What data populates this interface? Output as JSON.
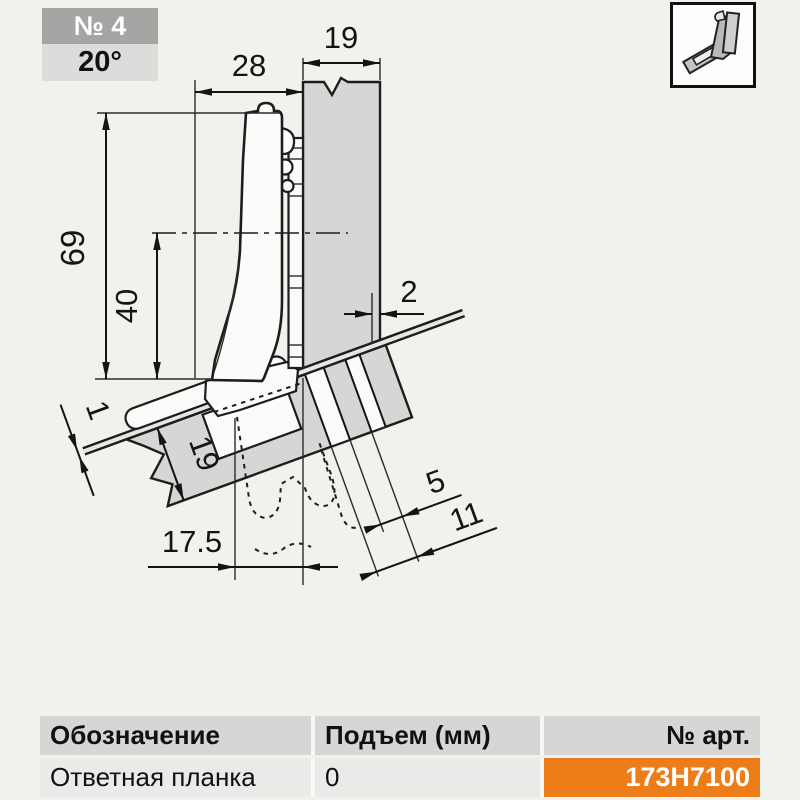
{
  "badge": {
    "number": "№ 4",
    "angle": "20°"
  },
  "thumbnail": {
    "icon": "hinge-side-view-icon"
  },
  "diagram": {
    "dimensions": {
      "side_panel_thickness": "19",
      "arm_depth": "28",
      "overall_height": "69",
      "center_height": "40",
      "back_offset": "2",
      "reveal": "1",
      "door_thickness": "19",
      "hole_offset_small": "5",
      "hole_offset_large": "11",
      "cup_distance": "17.5"
    }
  },
  "table": {
    "headers": [
      "Обозначение",
      "Подъем (мм)",
      "№ арт."
    ],
    "row": {
      "designation": "Ответная планка",
      "lift": "0",
      "art_no": "173H7100"
    }
  },
  "colors": {
    "accent_orange": "#ED7D18",
    "header_gray": "#D6D6D4",
    "row_gray": "#EAEAE8",
    "badge_dark": "#A5A5A3",
    "badge_light": "#DCDCDA"
  }
}
